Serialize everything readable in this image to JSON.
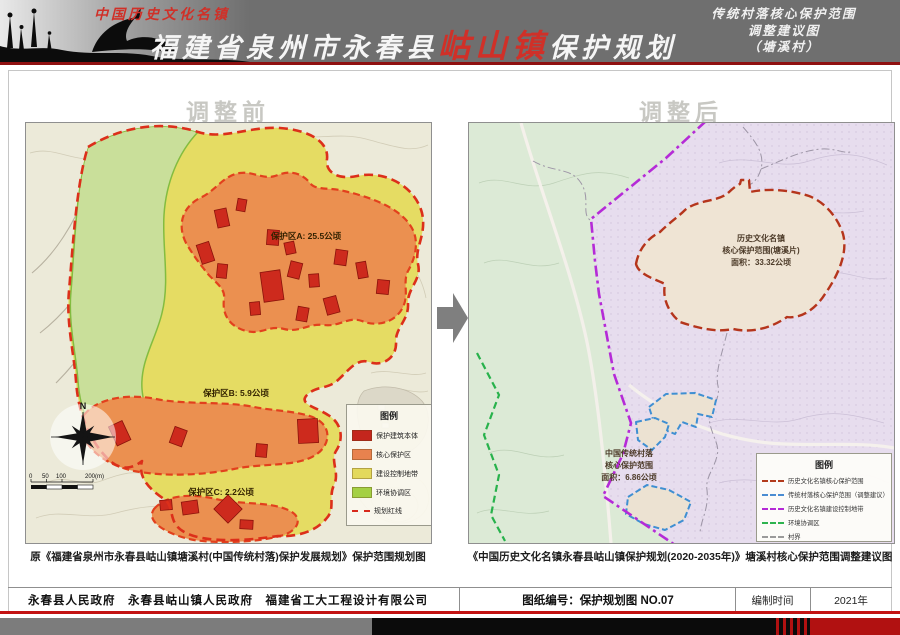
{
  "header": {
    "tagline": "中国历史文化名镇",
    "title_prefix": "福建省泉州市永春县",
    "title_highlight": "岵山镇",
    "title_suffix": "保护规划",
    "subtitle_lines": [
      "传统村落核心保护范围",
      "调整建议图",
      "（塘溪村）"
    ]
  },
  "before": {
    "title": "调整前",
    "caption": "原《福建省泉州市永春县岵山镇塘溪村(中国传统村落)保护发展规划》保护范围规划图",
    "zone_a_label": "保护区A: 25.5公顷",
    "zone_b_label": "保护区B: 5.9公顷",
    "zone_c_label": "保护区C: 2.2公顷",
    "compass_n": "N",
    "scale_ticks": [
      "0",
      "50",
      "100",
      "200(m)"
    ],
    "legend": {
      "title": "图例",
      "items": [
        {
          "label": "保护建筑本体",
          "color": "#c4261d",
          "style": "swatch"
        },
        {
          "label": "核心保护区",
          "color": "#e8824e",
          "style": "swatch"
        },
        {
          "label": "建设控制地带",
          "color": "#e3d95c",
          "style": "swatch"
        },
        {
          "label": "环境协调区",
          "color": "#a4d044",
          "style": "swatch"
        },
        {
          "label": "规划红线",
          "color": "#d8291b",
          "style": "dashed-line"
        }
      ]
    }
  },
  "after": {
    "title": "调整后",
    "caption": "《中国历史文化名镇永春县岵山镇保护规划(2020-2035年)》塘溪村核心保护范围调整建议图",
    "core_label_lines": [
      "历史文化名镇",
      "核心保护范围(塘溪片)",
      "面积：33.32公顷"
    ],
    "village_label_lines": [
      "中国传统村落",
      "核心保护范围",
      "面积：6.86公顷"
    ],
    "legend": {
      "title": "图例",
      "items": [
        {
          "label": "历史文化名镇核心保护范围",
          "color": "#b23a1b",
          "style": "dashed-line"
        },
        {
          "label": "传统村落核心保护范围（调整建议）",
          "color": "#4a8cd2",
          "style": "dashed-line"
        },
        {
          "label": "历史文化名镇建设控制地带",
          "color": "#b42ad6",
          "style": "dashdot-line"
        },
        {
          "label": "环境协调区",
          "color": "#2eb34f",
          "style": "dashed-line"
        },
        {
          "label": "村界",
          "color": "#9a9a9a",
          "style": "dashdot-line"
        }
      ]
    }
  },
  "footer": {
    "agencies": "永春县人民政府　永春县岵山镇人民政府　福建省工大工程设计有限公司",
    "sheet_no": "图纸编号：保护规划图  NO.07",
    "time_label": "编制时间",
    "time_value": "2021年"
  }
}
